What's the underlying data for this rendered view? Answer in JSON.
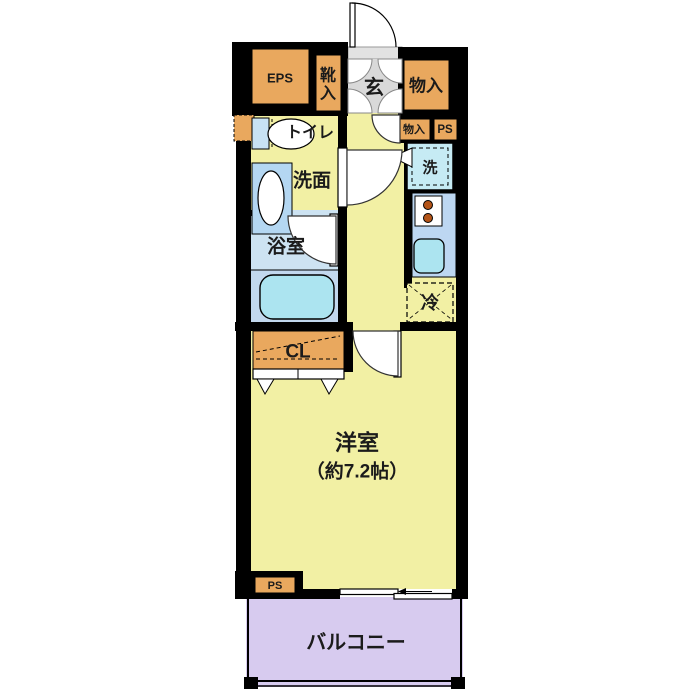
{
  "plan": {
    "type": "floorplan",
    "rooms": {
      "eps": {
        "label": "EPS"
      },
      "shoe_cabinet": {
        "label": "靴入",
        "chars": [
          "靴",
          "入"
        ]
      },
      "entrance": {
        "label": "玄"
      },
      "storage_top": {
        "label": "物入"
      },
      "storage_small": {
        "label": "物入"
      },
      "ps_upper": {
        "label": "PS"
      },
      "laundry": {
        "label": "洗"
      },
      "toilet": {
        "label": "トイレ"
      },
      "washroom": {
        "label": "洗面"
      },
      "bathroom": {
        "label": "浴室"
      },
      "refrigerator": {
        "label": "冷"
      },
      "closet": {
        "label": "CL"
      },
      "western_room": {
        "label": "洋室",
        "size": "（約7.2帖）"
      },
      "ps_lower": {
        "label": "PS"
      },
      "balcony": {
        "label": "バルコニー"
      }
    },
    "colors": {
      "wall": "#000000",
      "floor_yellow": "#F2F0A4",
      "storage_orange": "#E9A85E",
      "entrance_gray": "#D9D9D9",
      "bath_blue": "#CDE3F2",
      "bath_lower_blue": "#C2D8EE",
      "fixture_cyan": "#ACE4F0",
      "counter_blue": "#BDD7F2",
      "laundry_cyan": "#C6EBF4",
      "balcony_purple": "#D7CBEF",
      "burner_brown": "#B35418"
    }
  }
}
